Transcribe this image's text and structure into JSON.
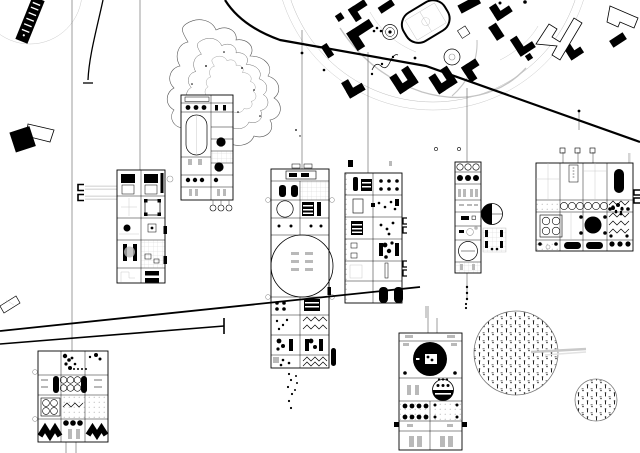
{
  "canvas": {
    "width": 640,
    "height": 453
  },
  "palette": {
    "ink": "#000000",
    "paper": "#ffffff",
    "faint_line": "#c4c4c4",
    "mid_gray": "#9a9a9a",
    "band_gray": "#dddddd"
  },
  "scene": {
    "kind": "architectural masterplan drawing, black ink on white",
    "elements": [
      {
        "name": "angled-tower-topleft",
        "bbox": [
          18,
          0,
          32,
          44
        ],
        "motif": "solid black rotated slab with white tick marks and faint arc below"
      },
      {
        "name": "rotated-square-marker-left",
        "bbox": [
          10,
          120,
          42,
          38
        ],
        "motif": "solid black tilted square with outlined trapezoid"
      },
      {
        "name": "campus-ring",
        "bbox": [
          295,
          0,
          300,
          145
        ],
        "motif": "large faint double circle boundary"
      },
      {
        "name": "campus-buildings",
        "bbox": [
          320,
          0,
          320,
          100
        ],
        "motif": "solid black L / U / bar buildings rotated ~-33deg"
      },
      {
        "name": "sports-field",
        "bbox": [
          398,
          0,
          55,
          45
        ],
        "motif": "rotated stadium track with court"
      },
      {
        "name": "lake-contours",
        "bbox": [
          170,
          20,
          130,
          130
        ],
        "motif": "nested topographic contour blob with speckles"
      },
      {
        "name": "bracket-band-glyphs",
        "bbox": [
          77,
          184,
          42,
          16
        ],
        "motif": "two C-brackets with faint gray bands"
      },
      {
        "name": "floorplan-strip-p1",
        "bbox": [
          117,
          170,
          48,
          113
        ],
        "motif": "2x5 room grid: beds, corner-bracket room, dot, bars, shelves"
      },
      {
        "name": "floorplan-strip-p2",
        "bbox": [
          181,
          95,
          52,
          105
        ],
        "motif": "tall strip: dot rows, oval track, black discs, hatch, hanging circles"
      },
      {
        "name": "floorplan-strip-p3",
        "bbox": [
          271,
          169,
          58,
          199
        ],
        "motif": "tall strip: header, beds, circle, striped block, large circle hall, zigzags, dot clusters"
      },
      {
        "name": "floorplan-strip-p4",
        "bbox": [
          345,
          173,
          57,
          130
        ],
        "motif": "strip: pill, striped blocks, speckle rooms, twin black pills at base"
      },
      {
        "name": "floorplan-strip-p5",
        "bbox": [
          455,
          162,
          26,
          111
        ],
        "motif": "narrow strip: circle row, dot row, slots, large circle; side pie-chart circle and mini grid"
      },
      {
        "name": "floorplan-square-p6",
        "bbox": [
          536,
          163,
          97,
          88
        ],
        "motif": "4x4 grid: dotted column, circle row, stove, big black disc, zigzag column, pill row"
      },
      {
        "name": "floorplan-strip-p7",
        "bbox": [
          38,
          351,
          70,
          91
        ],
        "motif": "3x4 grid: speckles, circle grid with pills, stove, zigzag bands, dot row"
      },
      {
        "name": "floorplan-strip-p8",
        "bbox": [
          399,
          333,
          63,
          117
        ],
        "motif": "strip: big black disc with white window, half-black dial, dot rows, slot cells"
      },
      {
        "name": "tree-circle-large",
        "bbox": [
          474,
          311,
          84,
          84
        ],
        "motif": "circle filled with planting texture, gray band to right"
      },
      {
        "name": "tree-circle-small",
        "bbox": [
          575,
          379,
          43,
          43
        ],
        "motif": "small circle filled with planting texture"
      },
      {
        "name": "curved-drop-line",
        "bbox": [
          85,
          0,
          22,
          86
        ],
        "motif": "thin curve ending in tick"
      },
      {
        "name": "road-a",
        "bbox": [
          225,
          0,
          415,
          142
        ],
        "motif": "heavy diagonal road upper right"
      },
      {
        "name": "road-b",
        "bbox": [
          0,
          287,
          424,
          60
        ],
        "motif": "two heavy shallow diagonals lower left, one ending in T-bar"
      }
    ]
  },
  "feeder_lines": [
    {
      "x": 72,
      "y1": 0,
      "y2": 351
    },
    {
      "x": 140,
      "y1": 0,
      "y2": 170
    },
    {
      "x": 302,
      "y1": 30,
      "y2": 185
    },
    {
      "x": 368,
      "y1": 52,
      "y2": 173
    },
    {
      "x": 467,
      "y1": 88,
      "y2": 162
    },
    {
      "x": 467,
      "y1": 273,
      "y2": 300
    },
    {
      "x": 563,
      "y1": 152,
      "y2": 163
    },
    {
      "x": 578,
      "y1": 152,
      "y2": 163
    },
    {
      "x": 593,
      "y1": 152,
      "y2": 163
    },
    {
      "x": 428,
      "y1": 318,
      "y2": 333
    },
    {
      "x": 437,
      "y1": 318,
      "y2": 333
    },
    {
      "x": 66,
      "y1": 442,
      "y2": 453
    },
    {
      "x": 76,
      "y1": 442,
      "y2": 453
    },
    {
      "x": 579,
      "y1": 112,
      "y2": 130
    }
  ],
  "roads": [
    {
      "name": "road-a",
      "d": "M225,0 C235,16 252,30 280,40 L426,66 L640,142",
      "w": 2.2
    },
    {
      "name": "road-b-long",
      "d": "M0,331 L420,287",
      "w": 1.8
    },
    {
      "name": "road-b-short",
      "d": "M0,344 L224,326",
      "w": 1.6
    },
    {
      "name": "road-b-tick",
      "d": "M224,318 L224,334",
      "w": 1.6
    }
  ],
  "tree_circles": [
    {
      "cx": 516,
      "cy": 353,
      "r": 42
    },
    {
      "cx": 596,
      "cy": 400,
      "r": 21
    }
  ],
  "plans": {
    "p1": {
      "x": 117,
      "y": 170
    },
    "p2": {
      "x": 181,
      "y": 95
    },
    "p3": {
      "x": 271,
      "y": 169
    },
    "p4": {
      "x": 345,
      "y": 173
    },
    "p5": {
      "x": 455,
      "y": 162
    },
    "p6": {
      "x": 536,
      "y": 163
    },
    "p7": {
      "x": 38,
      "y": 351
    },
    "p8": {
      "x": 399,
      "y": 333
    }
  }
}
